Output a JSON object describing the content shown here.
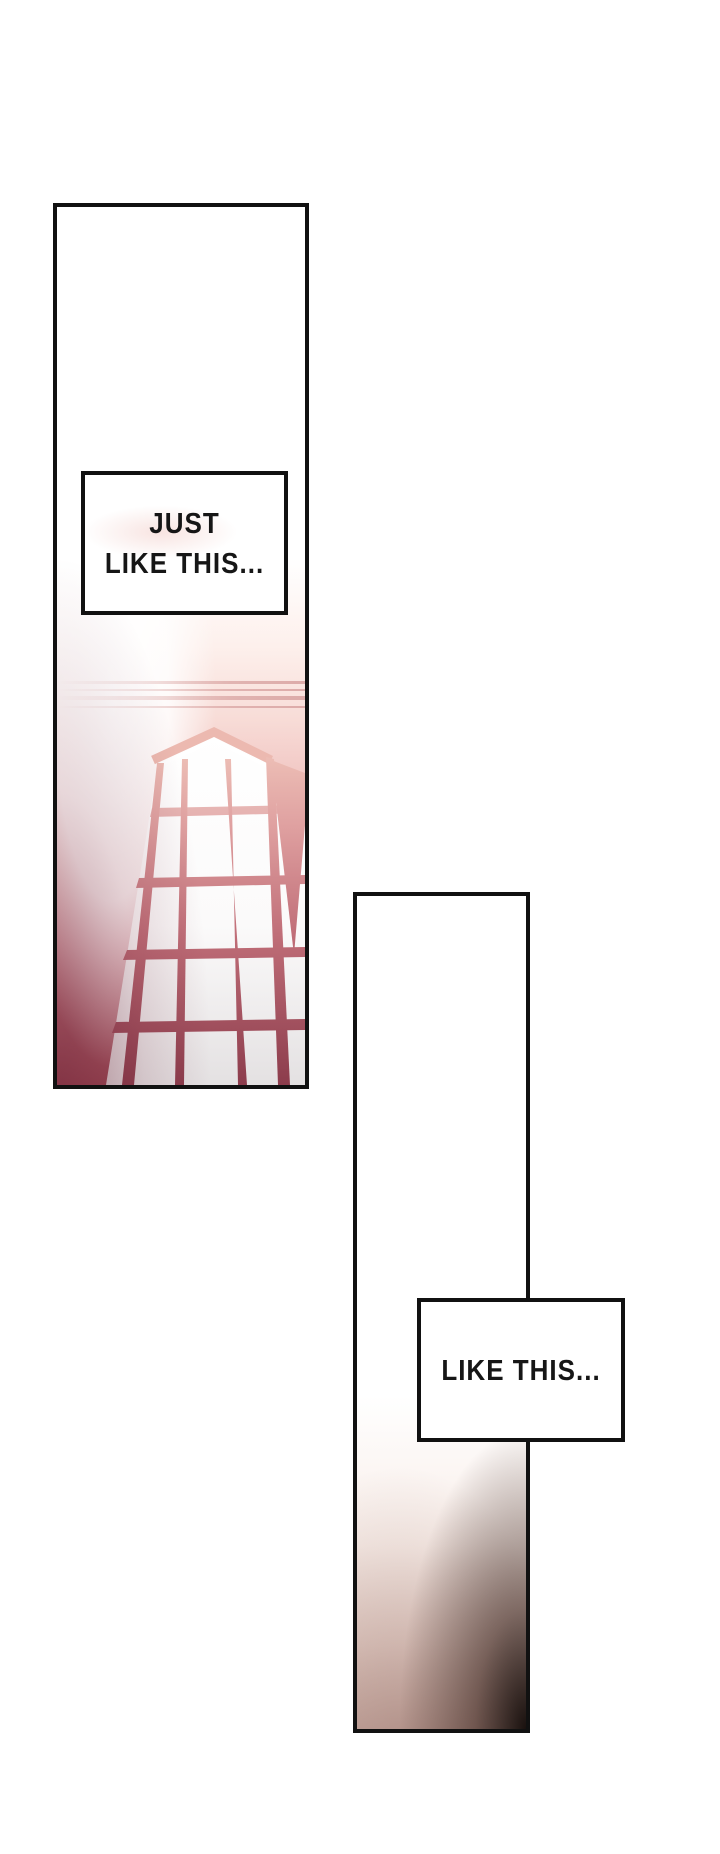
{
  "page": {
    "background": "#ffffff"
  },
  "panels": {
    "panel1": {
      "speech": {
        "line1": "JUST",
        "line2": "LIKE THIS..."
      }
    },
    "panel2": {
      "speech": {
        "line1": "LIKE THIS..."
      }
    }
  },
  "palette": {
    "ink": "#111111",
    "pink_bar_light": "#f2cabe",
    "maroon_mid": "#c06e78",
    "maroon_dark": "#8c3c4c",
    "wall_pink": "#e0a4a4",
    "wall_deep": "#9a4653",
    "glass_gray": "#e4e1e2",
    "molding_pink": "#dba8a6",
    "shadow_corner": "#140c0a"
  }
}
